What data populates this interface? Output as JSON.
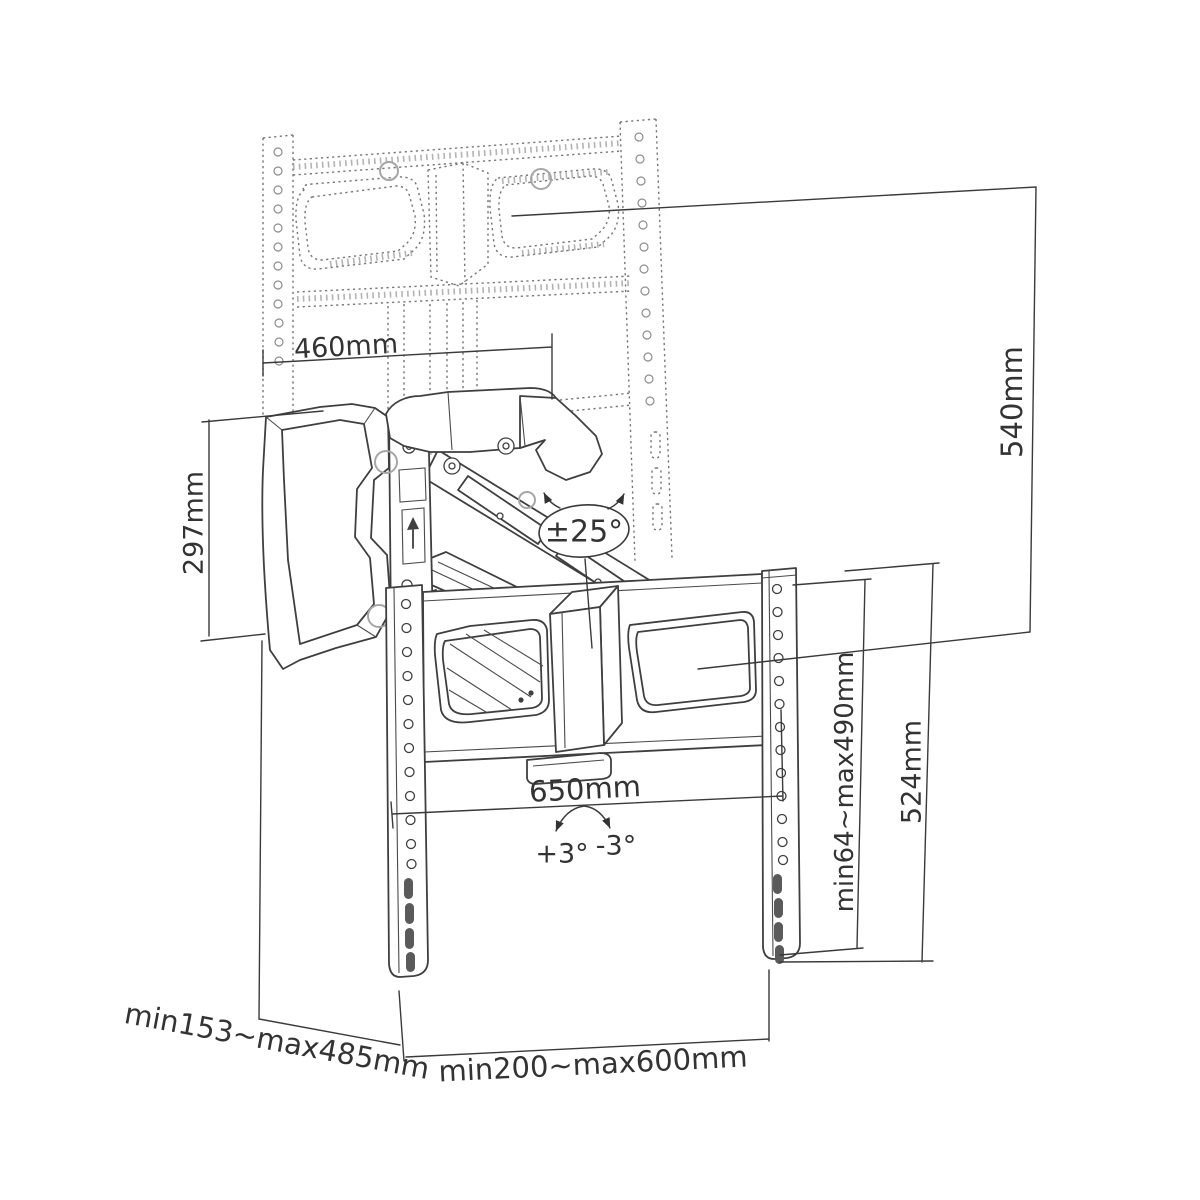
{
  "diagram": {
    "title": "tv-wall-mount-pull-down-dimension-drawing",
    "background": "#ffffff",
    "line_color": "#3f3f3f",
    "dashed_color": "#757575",
    "text_color": "#333333",
    "labels": {
      "wall_plate_width": "460mm",
      "wall_plate_height": "297mm",
      "drop_height": "540mm",
      "bracket_width": "650mm",
      "vesa_vertical_range": "min64~max490mm",
      "rail_height": "524mm",
      "extension_depth_range": "min153~max485mm",
      "vesa_horizontal_range": "min200~max600mm",
      "swivel_angle": "±25°",
      "tilt_up": "+3°",
      "tilt_down": "-3°"
    }
  }
}
